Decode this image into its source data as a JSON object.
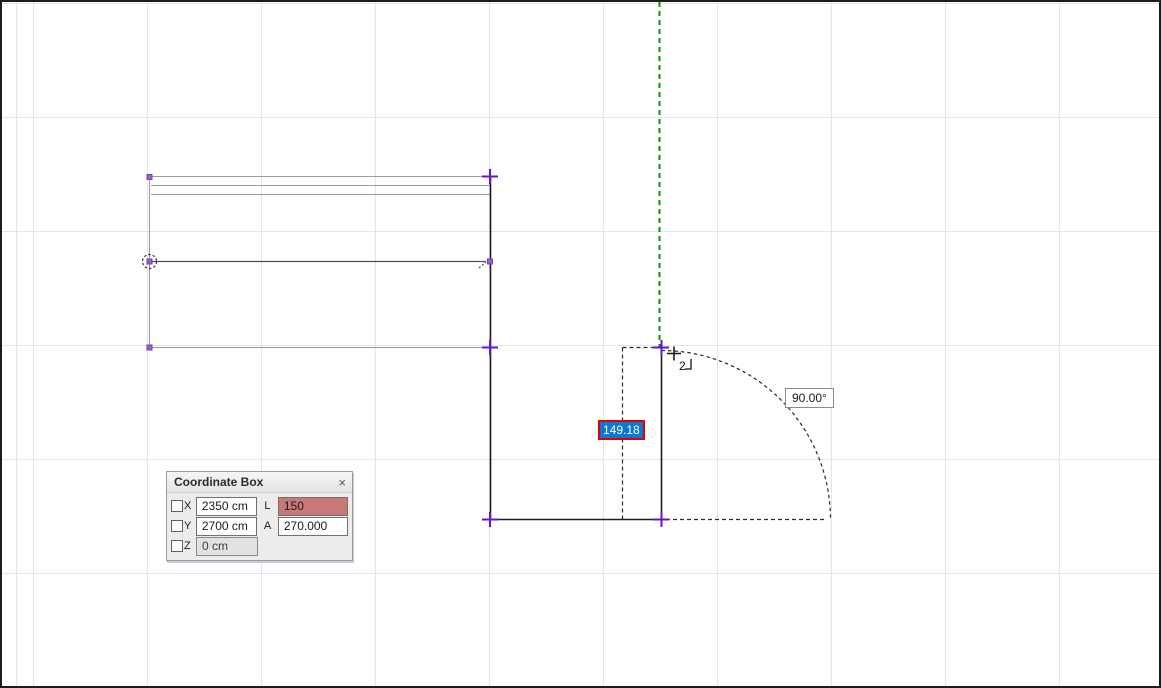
{
  "canvas": {
    "angle_label": "90.00°",
    "length_edit_value": "149.18",
    "cursor_badge": "2"
  },
  "coordinate_box": {
    "title": "Coordinate Box",
    "close_label": "×",
    "rows": [
      {
        "axis": "X",
        "value": "2350 cm",
        "param_label": "L",
        "param_value": "150"
      },
      {
        "axis": "Y",
        "value": "2700 cm",
        "param_label": "A",
        "param_value": "270.000"
      },
      {
        "axis": "Z",
        "value": "0 cm"
      }
    ]
  },
  "colors": {
    "guide_green": "#009a00",
    "selection_blue": "#0b79d0",
    "edit_border_red": "#e20000",
    "field_highlight": "#c97878",
    "marker_purple": "#6a11cb",
    "hotspot_purple": "#a05fd0",
    "grid_line": "#e4e4ef"
  }
}
